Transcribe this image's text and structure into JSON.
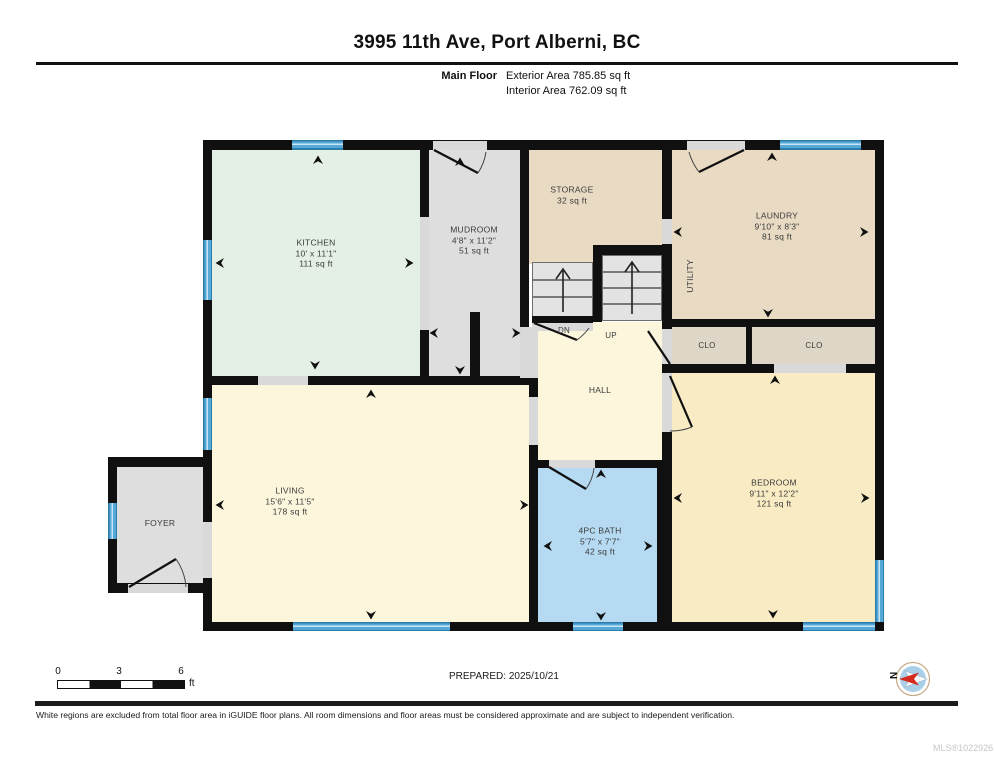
{
  "header": {
    "title": "3995 11th Ave, Port Alberni, BC",
    "floor_label": "Main Floor",
    "exterior_area": "Exterior Area 785.85 sq ft",
    "interior_area": "Interior Area 762.09 sq ft"
  },
  "rooms": {
    "kitchen": {
      "name": "KITCHEN",
      "dims": "10' x 11'1\"",
      "area": "111 sq ft"
    },
    "mudroom": {
      "name": "MUDROOM",
      "dims": "4'8\" x 11'2\"",
      "area": "51 sq ft"
    },
    "storage": {
      "name": "STORAGE",
      "area": "32 sq ft"
    },
    "laundry": {
      "name": "LAUNDRY",
      "dims": "9'10\" x 8'3\"",
      "area": "81 sq ft"
    },
    "utility": {
      "name": "UTILITY"
    },
    "closet1": {
      "name": "CLO"
    },
    "closet2": {
      "name": "CLO"
    },
    "hall": {
      "name": "HALL"
    },
    "living": {
      "name": "LIVING",
      "dims": "15'6\" x 11'5\"",
      "area": "178 sq ft"
    },
    "foyer": {
      "name": "FOYER"
    },
    "bath": {
      "name": "4PC BATH",
      "dims": "5'7\" x 7'7\"",
      "area": "42 sq ft"
    },
    "bedroom": {
      "name": "BEDROOM",
      "dims": "9'11\" x 12'2\"",
      "area": "121 sq ft"
    }
  },
  "stairs": {
    "down_label": "DN",
    "up_label": "UP"
  },
  "scale_bar": {
    "ticks": [
      "0",
      "3",
      "6"
    ],
    "unit": "ft"
  },
  "compass": {
    "letter": "N"
  },
  "footer": {
    "prepared": "PREPARED: 2025/10/21",
    "disclaimer": "White regions are excluded from total floor area in iGUIDE floor plans. All room dimensions and floor areas must be considered approximate and are subject to independent verification.",
    "mls": "MLS®1022926"
  },
  "colors": {
    "kitchen": "#e4f0e6",
    "mudroom": "#dedede",
    "beige": "#e9dac3",
    "closet": "#ded6c6",
    "cream": "#fcf6dd",
    "bedroom": "#f9ecc4",
    "bath": "#b5daf2",
    "window": "#56a8d7",
    "wall": "#101010"
  }
}
